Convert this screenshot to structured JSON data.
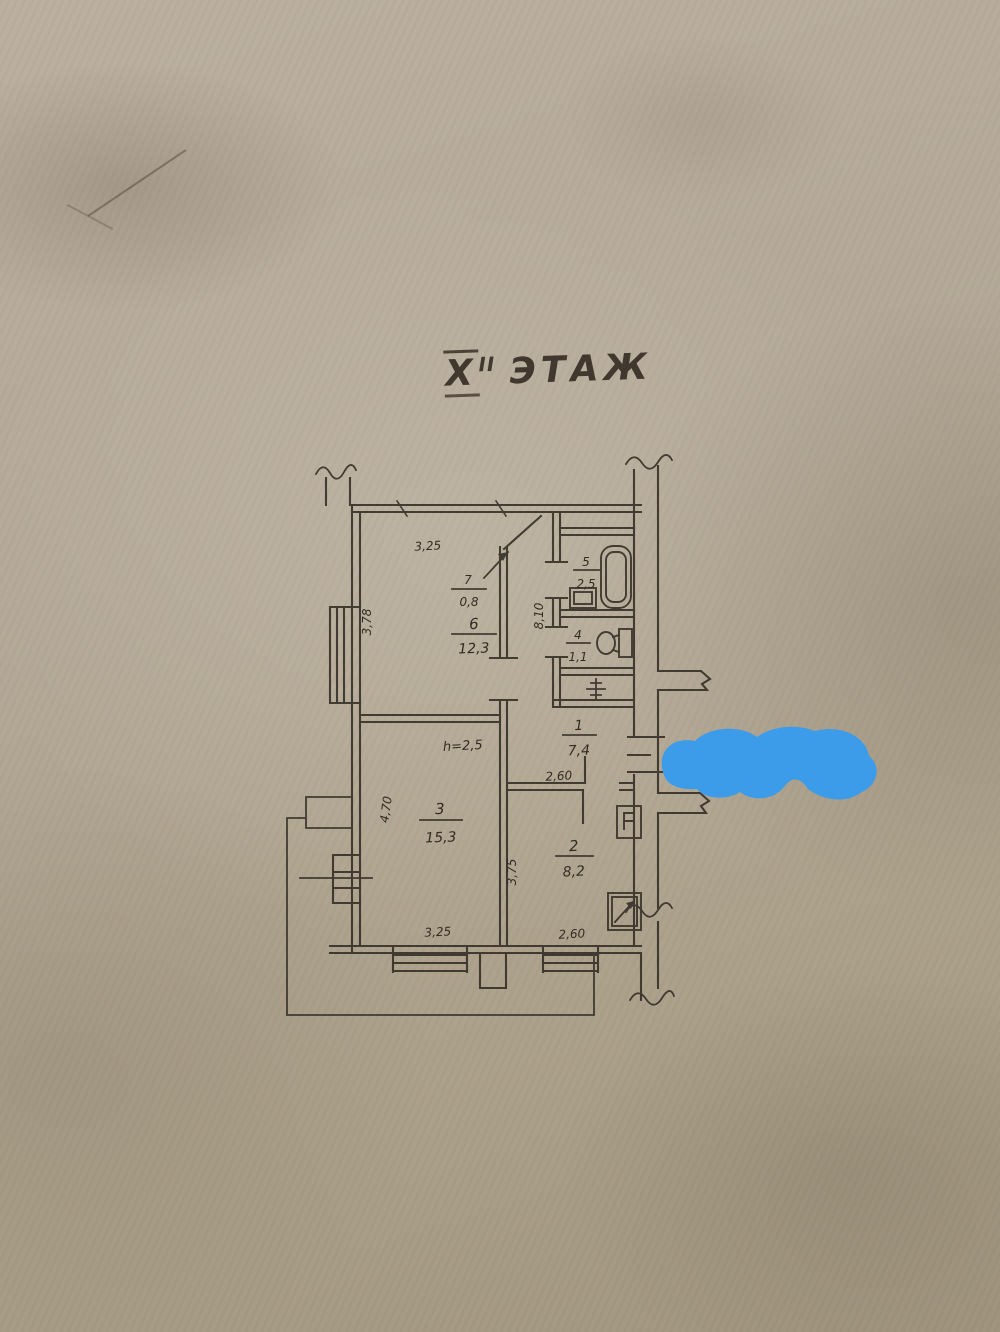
{
  "title": {
    "roman": "X",
    "superscript": "II",
    "word": "ЭТАЖ"
  },
  "rooms": [
    {
      "id": "hall",
      "number": "1",
      "area": "7,4"
    },
    {
      "id": "kitchen",
      "number": "2",
      "area": "8,2"
    },
    {
      "id": "living",
      "number": "3",
      "area": "15,3"
    },
    {
      "id": "wc",
      "number": "4",
      "area": "1,1"
    },
    {
      "id": "bath",
      "number": "5",
      "area": "2,5"
    },
    {
      "id": "bedroom",
      "number": "6",
      "area": "12,3"
    },
    {
      "id": "closet",
      "number": "7",
      "area": "0,8"
    }
  ],
  "dimensions": {
    "room6_top": "3,25",
    "room6_left": "3,78",
    "corridor_depth": "8,10",
    "hall_width": "2,60",
    "room2_bottom": "2,60",
    "room2_left": "3,75",
    "room3_bottom": "3,25",
    "room3_left": "4,70",
    "ceiling_height": "h=2,5"
  },
  "colors": {
    "paper": "#b2a795",
    "ink": "#332c24",
    "marker": "#3d9ce9"
  }
}
